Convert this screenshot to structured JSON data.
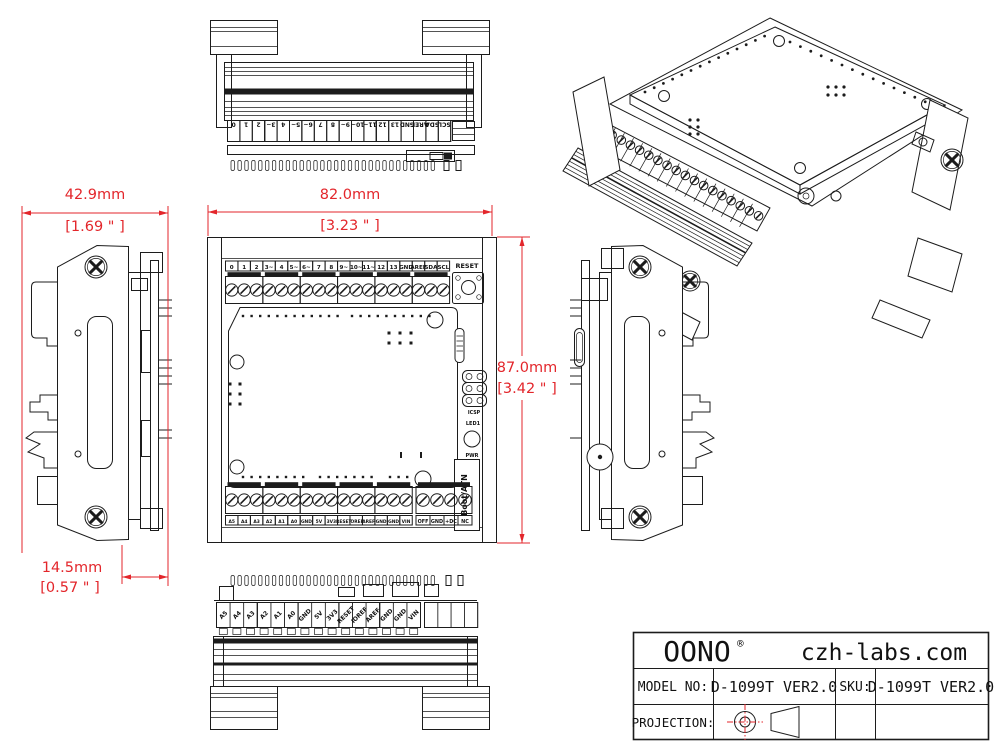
{
  "colors": {
    "ink": "#1c1c1c",
    "dimension_red": "#e3262b",
    "paper": "#ffffff"
  },
  "dimensions": {
    "top_width": {
      "mm": "42.9mm",
      "inch": "[1.69 \" ]"
    },
    "front_width": {
      "mm": "82.0mm",
      "inch": "[3.23 \" ]"
    },
    "front_height": {
      "mm": "87.0mm",
      "inch": "[3.42 \" ]"
    },
    "side_depth": {
      "mm": "14.5mm",
      "inch": "[0.57 \" ]"
    }
  },
  "front_view": {
    "reset_label": "RESET",
    "icsp_label": "ICSP",
    "led1_label": "LED1",
    "pwr_label": "PWR",
    "boot_label": "Boot/ATN"
  },
  "terminals": {
    "digital_row": [
      "0",
      "1",
      "2",
      "3~",
      "4",
      "5~",
      "6~",
      "7",
      "8",
      "9~",
      "10~",
      "11~",
      "12",
      "13",
      "GND",
      "AREF",
      "SDA",
      "SCL"
    ],
    "analog_power_row": [
      "A5",
      "A4",
      "A3",
      "A2",
      "A1",
      "A0",
      "GND",
      "5V",
      "3V3",
      "RESET",
      "IOREF",
      "AREF",
      "GND",
      "GND",
      "VIN"
    ],
    "aux_row": [
      "OFF",
      "GND",
      "+DC",
      "NC"
    ]
  },
  "title_block": {
    "brand": "OONO",
    "reg_mark": "®",
    "website": "czh-labs.com",
    "model_label": "MODEL NO:",
    "model_value": "D-1099T VER2.0",
    "sku_label": "SKU:",
    "sku_value": "D-1099T VER2.0",
    "projection_label": "PROJECTION:"
  }
}
